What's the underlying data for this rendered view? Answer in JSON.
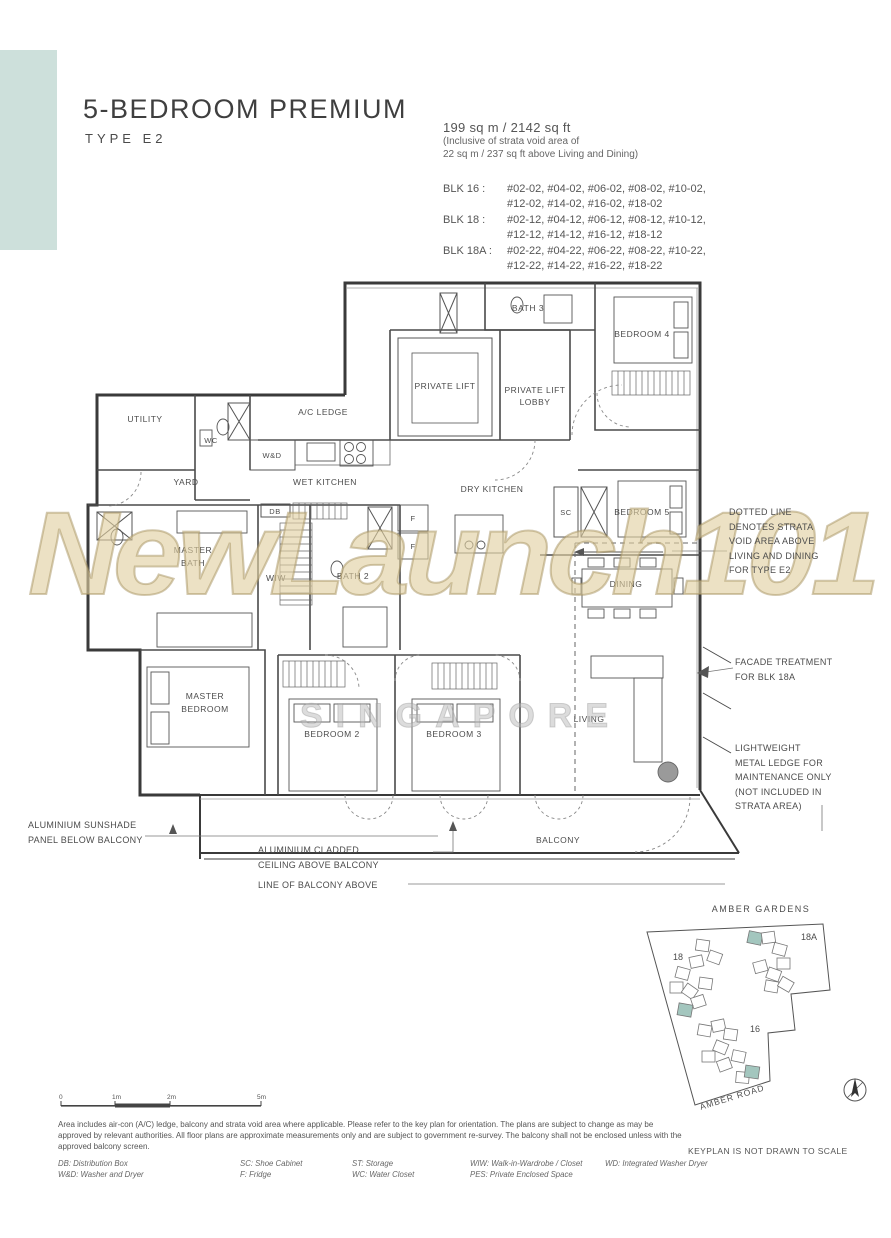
{
  "header": {
    "title": "5-BEDROOM PREMIUM",
    "subtitle": "TYPE E2"
  },
  "area": {
    "main": "199 sq m / 2142 sq ft",
    "note1": "(Inclusive of strata void area of",
    "note2": "22 sq m / 237 sq ft above Living and Dining)"
  },
  "blocks": [
    {
      "label": "BLK 16 :",
      "line1": "#02-02, #04-02, #06-02, #08-02, #10-02,",
      "line2": "#12-02, #14-02, #16-02, #18-02"
    },
    {
      "label": "BLK 18 :",
      "line1": "#02-12, #04-12, #06-12, #08-12, #10-12,",
      "line2": "#12-12, #14-12, #16-12, #18-12"
    },
    {
      "label": "BLK 18A :",
      "line1": "#02-22, #04-22, #06-22, #08-22, #10-22,",
      "line2": "#12-22, #14-22, #16-22, #18-22"
    }
  ],
  "rooms": {
    "bath3": "BATH 3",
    "bedroom4": "BEDROOM 4",
    "private_lift": "PRIVATE LIFT",
    "lobby_l1": "PRIVATE LIFT",
    "lobby_l2": "LOBBY",
    "utility": "UTILITY",
    "wc": "WC",
    "wd": "W&D",
    "ac_ledge": "A/C LEDGE",
    "yard": "YARD",
    "wet_kitchen": "WET KITCHEN",
    "dry_kitchen": "DRY KITCHEN",
    "db": "DB",
    "f": "F",
    "sc": "SC",
    "bedroom5": "BEDROOM 5",
    "master_bath_l1": "MASTER",
    "master_bath_l2": "BATH",
    "wiw": "WIW",
    "bath2": "BATH 2",
    "dining": "DINING",
    "master_bed_l1": "MASTER",
    "master_bed_l2": "BEDROOM",
    "bedroom2": "BEDROOM 2",
    "bedroom3": "BEDROOM 3",
    "living": "LIVING",
    "balcony": "BALCONY"
  },
  "annotations": {
    "strata": [
      "DOTTED LINE",
      "DENOTES STRATA",
      "VOID AREA ABOVE",
      "LIVING AND DINING",
      "FOR TYPE E2"
    ],
    "facade": [
      "FACADE TREATMENT",
      "FOR BLK 18A"
    ],
    "ledge": [
      "LIGHTWEIGHT",
      "METAL LEDGE FOR",
      "MAINTENANCE ONLY",
      "(NOT INCLUDED IN",
      "STRATA AREA)"
    ],
    "sunshade": [
      "ALUMINIUM SUNSHADE",
      "PANEL BELOW BALCONY"
    ],
    "cladded": [
      "ALUMINIUM CLADDED",
      "CEILING ABOVE BALCONY"
    ],
    "balcony_line": "LINE OF BALCONY ABOVE"
  },
  "watermark": {
    "main": "NewLaunch101",
    "sub": "SINGAPORE"
  },
  "keyplan": {
    "title": "AMBER GARDENS",
    "road": "AMBER ROAD",
    "blk18": "18",
    "blk18a": "18A",
    "blk16": "16",
    "note": "KEYPLAN IS NOT DRAWN TO SCALE"
  },
  "scalebar": {
    "t0": "0",
    "t1": "1m",
    "t2": "2m",
    "t5": "5m"
  },
  "footer": {
    "disclaimer": "Area includes air-con (A/C) ledge, balcony and strata void area where applicable. Please refer to the key plan for orientation. The plans are subject to change as may be approved by relevant authorities. All floor plans are approximate measurements only and are subject to government re-survey. The balcony shall not be enclosed unless with the approved balcony screen.",
    "legend": [
      [
        "DB: Distribution Box",
        "SC: Shoe Cabinet",
        "ST: Storage",
        "WIW: Walk-in-Wardrobe / Closet",
        "WD: Integrated Washer Dryer"
      ],
      [
        "W&D: Washer and Dryer",
        "F: Fridge",
        "WC: Water Closet",
        "PES: Private Enclosed Space"
      ]
    ]
  }
}
